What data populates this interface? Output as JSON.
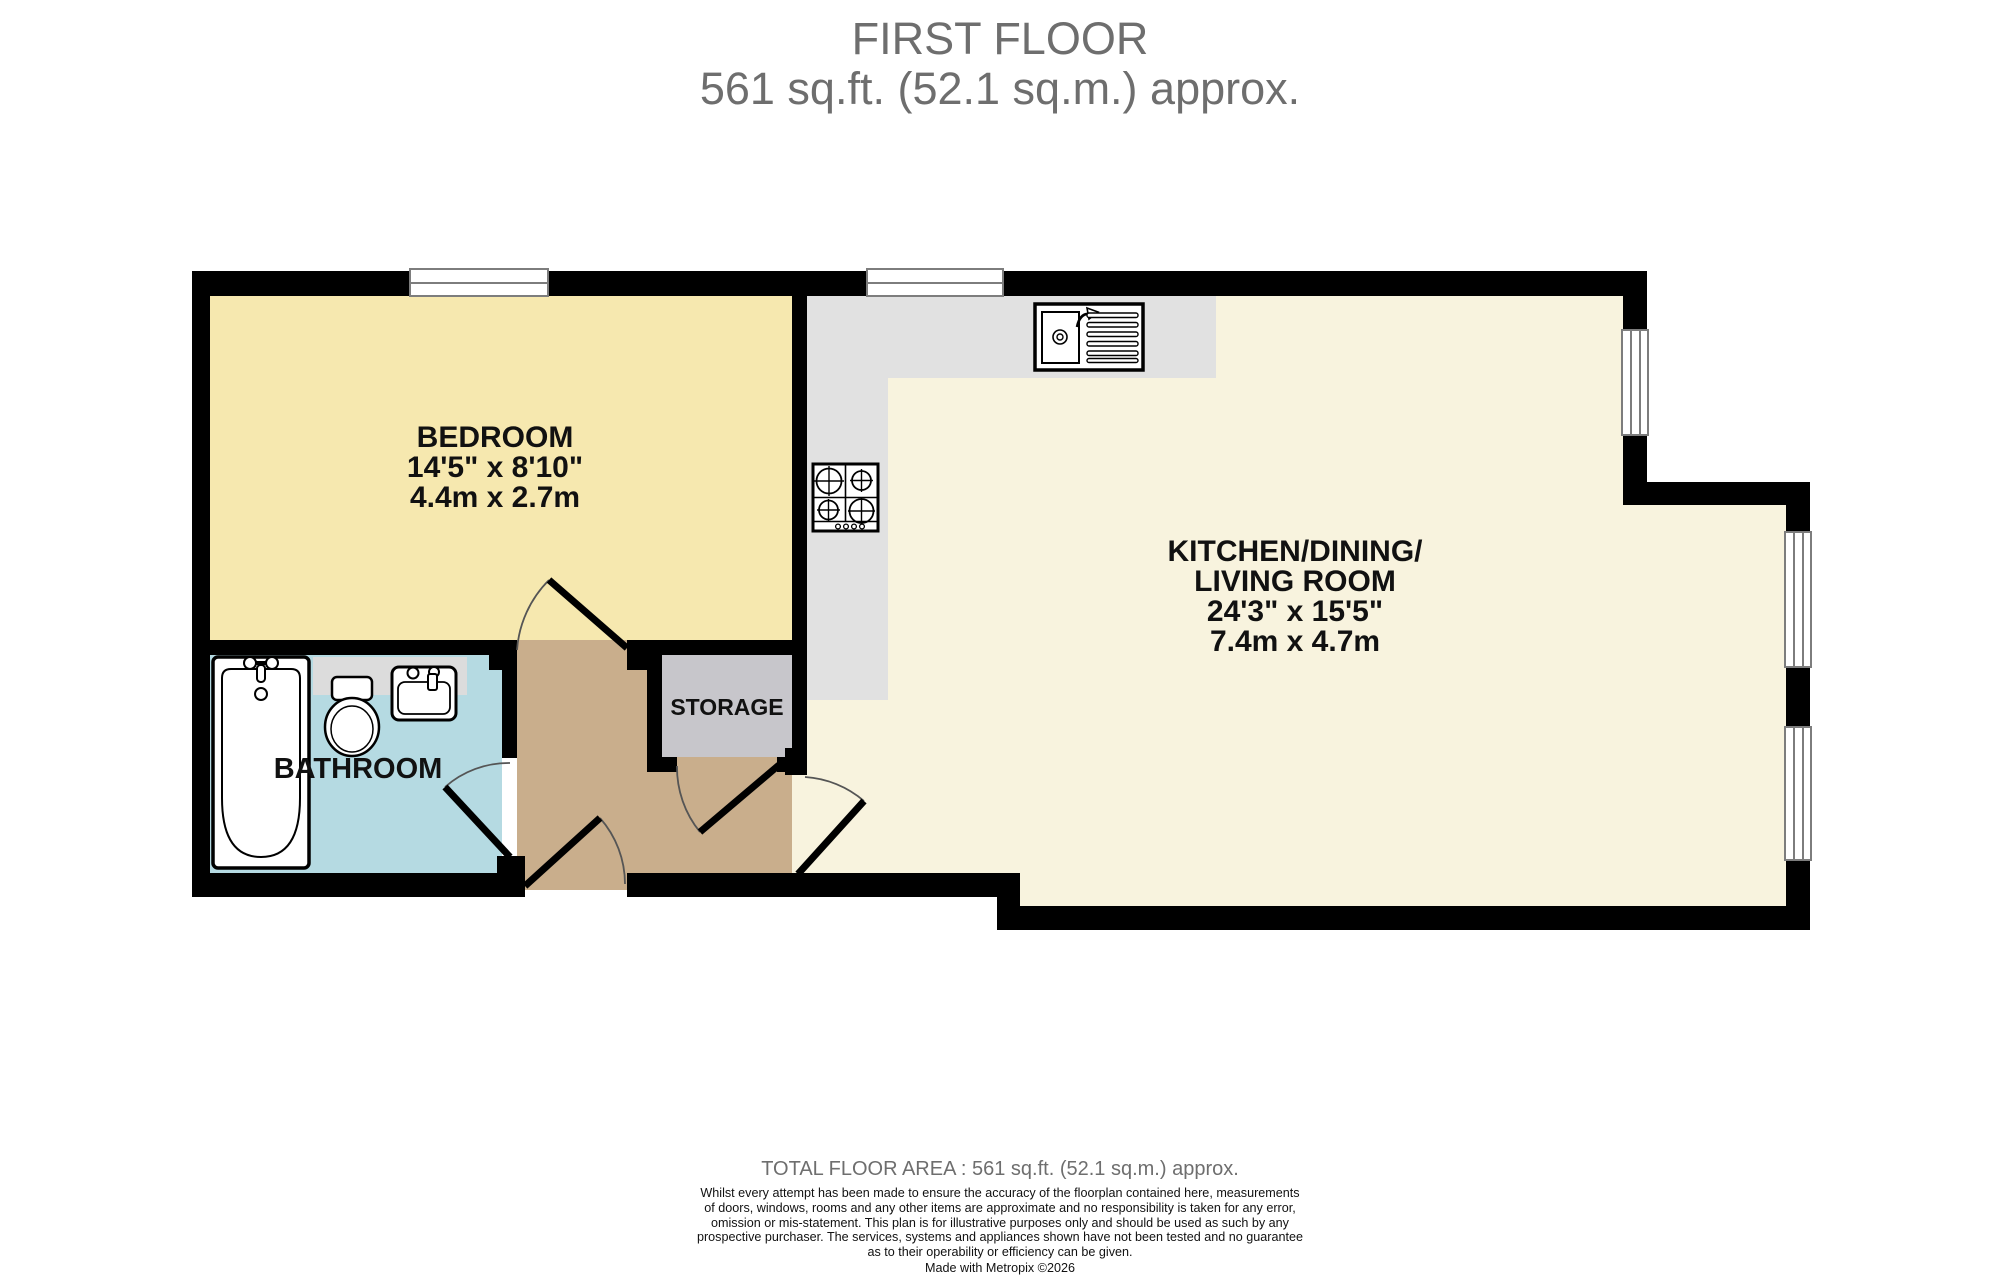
{
  "title": {
    "line1": "FIRST FLOOR",
    "line2": "561 sq.ft. (52.1 sq.m.) approx."
  },
  "rooms": {
    "bedroom": {
      "name": "BEDROOM",
      "imperial": "14'5\"  x 8'10\"",
      "metric": "4.4m  x 2.7m"
    },
    "kitchen": {
      "line1": "KITCHEN/DINING/",
      "line2": "LIVING ROOM",
      "imperial": "24'3\"  x 15'5\"",
      "metric": "7.4m  x 4.7m"
    },
    "bathroom": {
      "name": "BATHROOM"
    },
    "storage": {
      "name": "STORAGE"
    }
  },
  "plan": {
    "fixtures": [
      "bathtub",
      "toilet",
      "basin",
      "kitchen-sink",
      "hob"
    ],
    "colors": {
      "bedroom_floor": "#F6E8AF",
      "kitchen_floor": "#F8F3DE",
      "bathroom_floor": "#B5DAE2",
      "hallway_floor": "#C9AE8C",
      "storage_floor": "#C7C6CB",
      "counter": "#E1E1E1",
      "wall": "#000000",
      "title_text": "#6E6E6E"
    }
  },
  "footer": {
    "total": "TOTAL FLOOR AREA : 561 sq.ft. (52.1 sq.m.) approx.",
    "disclaimer": "Whilst every attempt has been made to ensure the accuracy of the floorplan contained here, measurements\nof doors, windows, rooms and any other items are approximate and no responsibility is taken for any error,\nomission or mis-statement. This plan is for illustrative purposes only and should be used as such by any\nprospective purchaser. The services, systems and appliances shown have not been tested and no guarantee\nas to their operability or efficiency can be given.",
    "credit": "Made with Metropix ©2026"
  }
}
